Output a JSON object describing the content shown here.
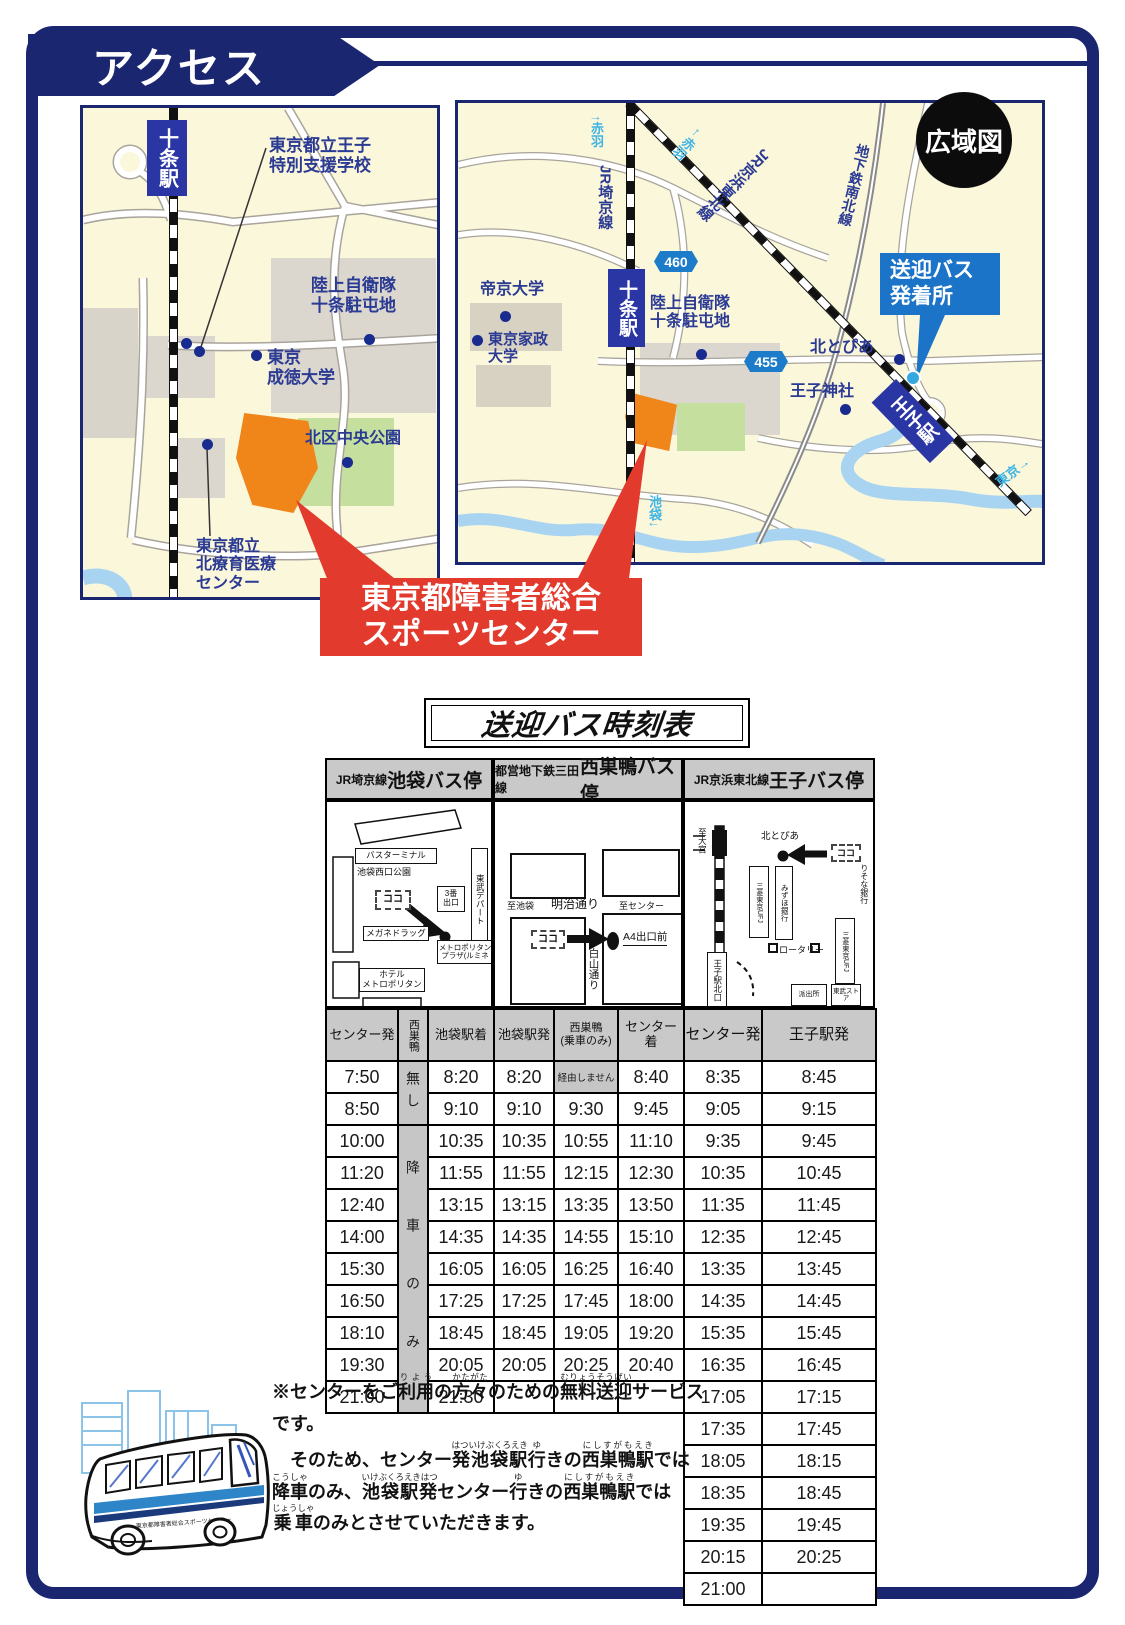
{
  "banner": {
    "title": "アクセス"
  },
  "left_map": {
    "station": "十条駅",
    "school": "東京都立王子\n特別支援学校",
    "garrison": "陸上自衛隊\n十条駐屯地",
    "seitoku": "東京\n成徳大学",
    "park": "北区中央公園",
    "medical": "東京都立\n北療育医療\nセンター"
  },
  "right_map": {
    "badge": "広域図",
    "akabane_up": "↑赤羽",
    "jr_saikyo": "JR埼京線",
    "akabane_left": "←赤羽",
    "jr_keihin": "JR京浜東北線",
    "subway_namboku": "地下鉄南北線",
    "route_460": "460",
    "route_455": "455",
    "teikyo": "帝京大学",
    "kasei": "東京家政\n大学",
    "jujo_station": "十条駅",
    "garrison": "陸上自衛隊\n十条駐屯地",
    "hokutopia": "北とぴあ",
    "oji_shrine": "王子神社",
    "oji_station": "王子駅",
    "shuttle_stop": "送迎バス\n発着所",
    "tokyo_dir": "東京→",
    "ikebukuro_dir": "池袋↓"
  },
  "center_callout": {
    "line1": "東京都障害者総合",
    "line2": "スポーツセンター"
  },
  "timetable": {
    "title": "送迎バス時刻表",
    "sections": [
      {
        "line": "JR埼京線",
        "stop": "池袋バス停"
      },
      {
        "line": "都営地下鉄三田線",
        "stop": "西巣鴨バス停"
      },
      {
        "line": "JR京浜東北線",
        "stop": "王子バス停"
      }
    ],
    "minimap1": {
      "terminal": "バスターミナル",
      "park": "池袋西口公園",
      "here": "ココ",
      "exit3": "3番\n出口",
      "tobu": "東武デパート",
      "megane": "メガネドラッグ",
      "plaza": "メトロポリタン\nプラザ(ルミネ",
      "hotel": "ホテル\nメトロポリタン"
    },
    "minimap2": {
      "to_ikebukuro": "至池袋",
      "meiji_dori": "明治通り",
      "to_center": "至センター",
      "here": "ココ",
      "a4_exit": "A4出口前",
      "hakusan_dori": "白山通り"
    },
    "minimap3": {
      "to_omiya": "至大宮",
      "hokutopia": "北とぴあ",
      "here": "ココ",
      "risona": "りそな銀行",
      "ufj1": "三菱東京UFJ",
      "mizuho": "みずほ銀行",
      "rotary": "ロータリー",
      "oji_north": "王子駅北口",
      "ufj2": "三菱東京UFJ",
      "police": "派出所",
      "tobu_store": "東武ストア"
    },
    "columns": [
      "センター発",
      "西巣鴨",
      "池袋駅着",
      "池袋駅発",
      "西巣鴨\n(乗車のみ)",
      "センター着",
      "センター発",
      "王子駅発"
    ],
    "nishisugamo": {
      "none": "無し",
      "dropoff_only": "降車のみ"
    },
    "left_rows": [
      [
        "7:50",
        "8:20",
        "8:20",
        "経由しません",
        "8:40"
      ],
      [
        "8:50",
        "9:10",
        "9:10",
        "9:30",
        "9:45"
      ],
      [
        "10:00",
        "10:35",
        "10:35",
        "10:55",
        "11:10"
      ],
      [
        "11:20",
        "11:55",
        "11:55",
        "12:15",
        "12:30"
      ],
      [
        "12:40",
        "13:15",
        "13:15",
        "13:35",
        "13:50"
      ],
      [
        "14:00",
        "14:35",
        "14:35",
        "14:55",
        "15:10"
      ],
      [
        "15:30",
        "16:05",
        "16:05",
        "16:25",
        "16:40"
      ],
      [
        "16:50",
        "17:25",
        "17:25",
        "17:45",
        "18:00"
      ],
      [
        "18:10",
        "18:45",
        "18:45",
        "19:05",
        "19:20"
      ],
      [
        "19:30",
        "20:05",
        "20:05",
        "20:25",
        "20:40"
      ],
      [
        "21:00",
        "21:30",
        "",
        "",
        ""
      ]
    ],
    "right_rows": [
      [
        "8:35",
        "8:45"
      ],
      [
        "9:05",
        "9:15"
      ],
      [
        "9:35",
        "9:45"
      ],
      [
        "10:35",
        "10:45"
      ],
      [
        "11:35",
        "11:45"
      ],
      [
        "12:35",
        "12:45"
      ],
      [
        "13:35",
        "13:45"
      ],
      [
        "14:35",
        "14:45"
      ],
      [
        "15:35",
        "15:45"
      ],
      [
        "16:35",
        "16:45"
      ],
      [
        "17:05",
        "17:15"
      ],
      [
        "17:35",
        "17:45"
      ],
      [
        "18:05",
        "18:15"
      ],
      [
        "18:35",
        "18:45"
      ],
      [
        "19:35",
        "19:45"
      ],
      [
        "20:15",
        "20:25"
      ],
      [
        "21:00",
        ""
      ]
    ]
  },
  "note": {
    "para1": [
      {
        "t": "※センターをご",
        "r": ""
      },
      {
        "t": "利用",
        "r": "りよう"
      },
      {
        "t": "の",
        "r": ""
      },
      {
        "t": "方々",
        "r": "かたがた"
      },
      {
        "t": "のための",
        "r": ""
      },
      {
        "t": "無料送迎",
        "r": "むりょうそうげい"
      },
      {
        "t": "サービスです。",
        "r": ""
      }
    ],
    "para2": [
      {
        "t": "そのため、センター",
        "r": ""
      },
      {
        "t": "発池袋駅",
        "r": "はついけぶくろえき"
      },
      {
        "t": "行",
        "r": "ゆ"
      },
      {
        "t": "きの",
        "r": ""
      },
      {
        "t": "西巣鴨駅",
        "r": "にしすがもえき"
      },
      {
        "t": "では",
        "r": ""
      },
      {
        "t": "降車",
        "r": "こうしゃ"
      },
      {
        "t": "のみ、",
        "r": ""
      },
      {
        "t": "池袋駅発",
        "r": "いけぶくろえきはつ"
      },
      {
        "t": "センター",
        "r": ""
      },
      {
        "t": "行",
        "r": "ゆ"
      },
      {
        "t": "きの",
        "r": ""
      },
      {
        "t": "西巣鴨駅",
        "r": "にしすがもえき"
      },
      {
        "t": "では",
        "r": ""
      },
      {
        "t": "乗車",
        "r": "じょうしゃ"
      },
      {
        "t": "のみとさせていただきます。",
        "r": ""
      }
    ]
  },
  "bus_side_text": "東京都障害者総合スポーツセンター"
}
